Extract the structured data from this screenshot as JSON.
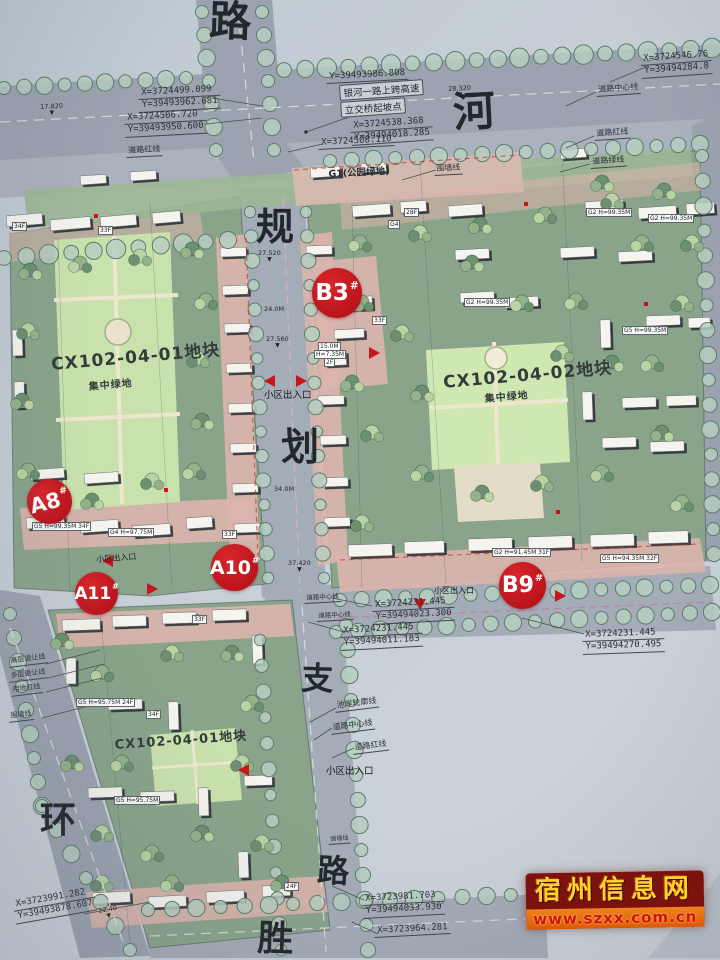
{
  "road_chars": {
    "top": "路",
    "river": "河",
    "gui": "规",
    "hua": "划",
    "zhi": "支",
    "lu_bottom": "路",
    "huan": "环",
    "sheng": "胜"
  },
  "plots": {
    "p1_name": "CX102-04-01地块",
    "p1_green": "集中绿地",
    "p2_name": "CX102-04-02地块",
    "p2_green": "集中绿地",
    "p3_name": "CX102-04-01地块"
  },
  "g1_label": "G1(公园绿地)",
  "bridge": {
    "l1": "银河一路上跨高速",
    "l2": "立交桥起坡点",
    "x": "X=3724538.368",
    "y": "Y=39494018.285"
  },
  "markers": {
    "b3": {
      "t": "B3",
      "s": "#"
    },
    "a8": {
      "t": "A8",
      "s": "#"
    },
    "a10": {
      "t": "A10",
      "s": "#"
    },
    "a11": {
      "t": "A11",
      "s": "#"
    },
    "b9": {
      "t": "B9",
      "s": "#"
    }
  },
  "coords": {
    "top_y": "Y=39493986.808",
    "tl1_x": "X=3724499.099",
    "tl1_y": "Y=39493962.681",
    "tl2_x": "X=3724506.720",
    "tl2_y": "Y=39493950.600",
    "mid_x": "X=3724508.110",
    "tr_x": "X=3724546.76",
    "tr_y": "Y=39494284.8",
    "jr1_x": "X=3724231.445",
    "jr1_y": "Y=39494023.300",
    "jr2_x": "X=3724231.445",
    "jr2_y": "Y=39494011.183",
    "br_x": "X=3724231.445",
    "br_y": "Y=39494270.495",
    "b1_x": "X=3723981.703",
    "b1_y": "Y=39494033.930",
    "b2_x": "X=3723964.281",
    "bl_x": "X=3723991.282",
    "bl_y": "Y=39493878.607"
  },
  "lines": {
    "center": "道路中心线",
    "red": "道路红线",
    "green": "道路绿线",
    "wall": "围墙线",
    "bank": "池岸轮廓线",
    "high": "高层退让线",
    "multi": "多层退让线",
    "land": "用地红线",
    "entry": "小区出入口"
  },
  "dims": {
    "d1": "17.820",
    "d2": "28.320",
    "d3": "27.520",
    "d4": "24.0M",
    "d5": "27.560",
    "d6": "34.0M",
    "d7": "37.420",
    "d8": "22.40"
  },
  "glyphs": {
    "dim_arrow": "▼"
  },
  "bldg": {
    "b1": "34F",
    "b2": "33F",
    "b3": "G4",
    "b4": "28F",
    "b5": "G2 H=99.35M",
    "b6": "G2 H=99.35M",
    "b7": "G2 H=99.35M",
    "b8": "33F",
    "b9": "G5 H=99.35M",
    "b10": "15.0M",
    "b11": "H=7.35M",
    "b12": "2F",
    "b13": "G5 H=99.35M 34F",
    "b14": "G4 H=97.75M",
    "b15": "G2 H=91.45M 31F",
    "b16": "G5 H=94.35M 32F",
    "b17": "G5 H=95.75M 24F",
    "b18": "G5 H=95.75M",
    "b19": "24F",
    "b20": "34F",
    "b21": "33F",
    "b22": "33F"
  },
  "watermark": {
    "title": "宿州信息网",
    "url": "www.szxx.com.cn"
  }
}
